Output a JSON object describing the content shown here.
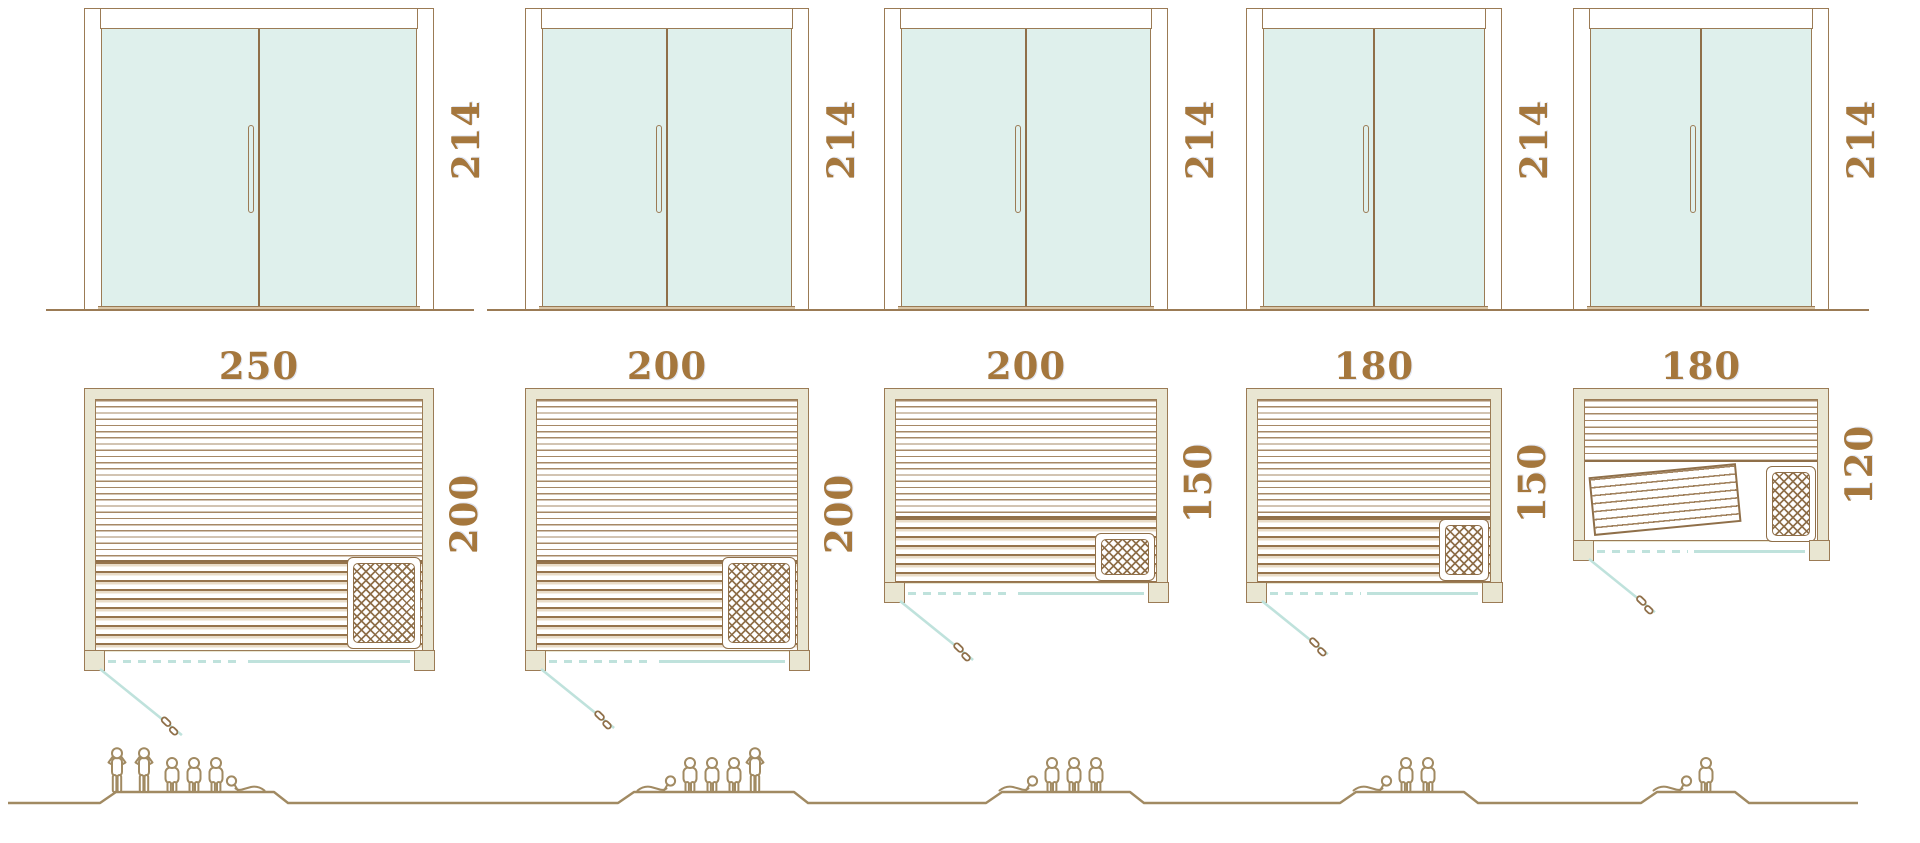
{
  "diagram_title": "sauna-size-comparison",
  "palette": {
    "outline_brown": "#9b7b55",
    "dark_brown": "#8f6f49",
    "label_text": "#a5773d",
    "wall_fill": "#e9e6d2",
    "glass_fill": "#dff0ec",
    "teal_line": "#bfe2dc",
    "figure_outline": "#a18a62",
    "background": "#ffffff"
  },
  "units": [
    {
      "name": "sauna-250x200",
      "door_height_label": "214",
      "width_label": "250",
      "depth_label": "200",
      "capacity": 6,
      "people": [
        "stand",
        "stand",
        "sit",
        "sit",
        "sit",
        "recline"
      ]
    },
    {
      "name": "sauna-200x200",
      "door_height_label": "214",
      "width_label": "200",
      "depth_label": "200",
      "capacity": 5,
      "people": [
        "recline",
        "sit",
        "sit",
        "sit",
        "stand"
      ]
    },
    {
      "name": "sauna-200x150",
      "door_height_label": "214",
      "width_label": "200",
      "depth_label": "150",
      "capacity": 4,
      "people": [
        "recline",
        "sit",
        "sit",
        "sit"
      ]
    },
    {
      "name": "sauna-180x150",
      "door_height_label": "214",
      "width_label": "180",
      "depth_label": "150",
      "capacity": 3,
      "people": [
        "recline",
        "sit",
        "sit"
      ]
    },
    {
      "name": "sauna-180x120",
      "door_height_label": "214",
      "width_label": "180",
      "depth_label": "120",
      "capacity": 2,
      "people": [
        "recline",
        "sit"
      ]
    }
  ]
}
